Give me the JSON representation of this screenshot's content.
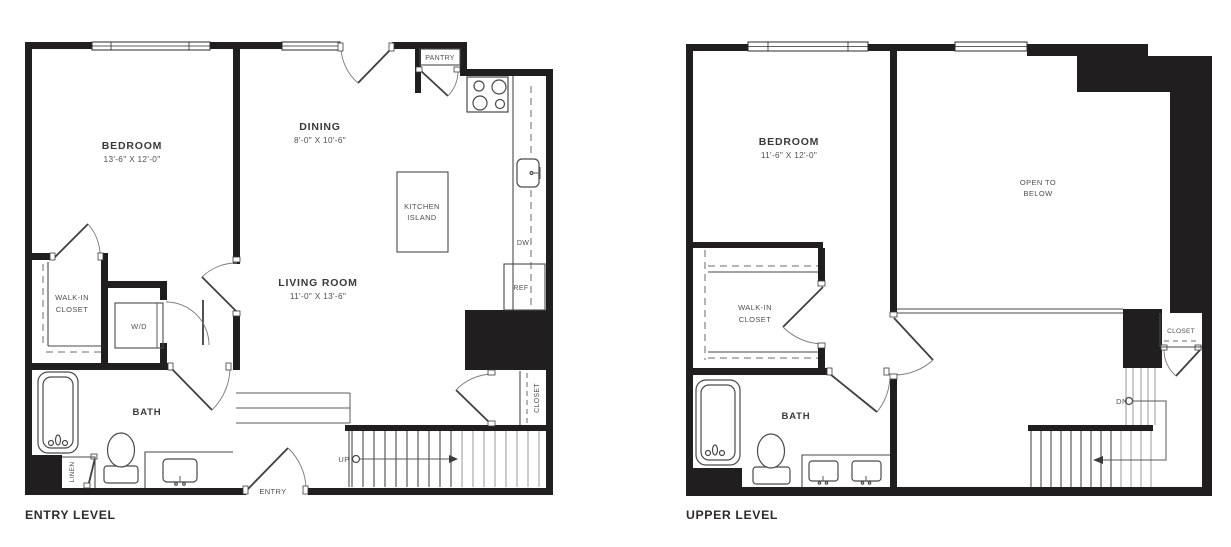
{
  "colors": {
    "wall": "#211e1f",
    "line": "#4a4a4a",
    "line_light": "#9a9a9a",
    "text_dark": "#3b3a3a",
    "text_gray": "#514f52",
    "background": "#ffffff"
  },
  "entry_level": {
    "title": "ENTRY LEVEL",
    "bedroom_name": "BEDROOM",
    "bedroom_dims": "13'-6\" X 12'-0\"",
    "dining_name": "DINING",
    "dining_dims": "8'-0\" X 10'-6\"",
    "living_name": "LIVING ROOM",
    "living_dims": "11'-0\" X 13'-6\"",
    "kitchen_island_1": "KITCHEN",
    "kitchen_island_2": "ISLAND",
    "walk_in_1": "WALK-IN",
    "walk_in_2": "CLOSET",
    "wd": "W/D",
    "bath": "BATH",
    "pantry": "PANTRY",
    "dw": "DW",
    "ref": "REF",
    "closet": "CLOSET",
    "linen": "LINEN",
    "up": "UP",
    "entry": "ENTRY"
  },
  "upper_level": {
    "title": "UPPER LEVEL",
    "bedroom_name": "BEDROOM",
    "bedroom_dims": "11'-6\" X 12'-0\"",
    "open_1": "OPEN TO",
    "open_2": "BELOW",
    "walk_in_1": "WALK-IN",
    "walk_in_2": "CLOSET",
    "bath": "BATH",
    "closet": "CLOSET",
    "dn": "DN"
  }
}
